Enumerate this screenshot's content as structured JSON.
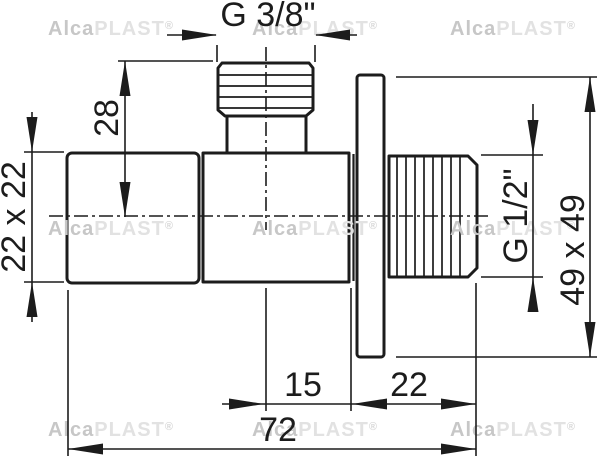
{
  "dimensions": {
    "inlet_thread": "G 3/8\"",
    "inlet_height": "28",
    "handle_section": "22 x 22",
    "outlet_thread": "G 1/2\"",
    "plate_section": "49 x 49",
    "axis_to_plate": "15",
    "plate_to_outlet_end": "22",
    "overall_length": "72"
  },
  "watermark": {
    "bold": "Alca",
    "light": "PLAST",
    "mark": "®"
  },
  "colors": {
    "line": "#1c1c1c",
    "background": "#ffffff",
    "watermark_bold": "#c7c7c7",
    "watermark_light": "#e2e2e2"
  }
}
